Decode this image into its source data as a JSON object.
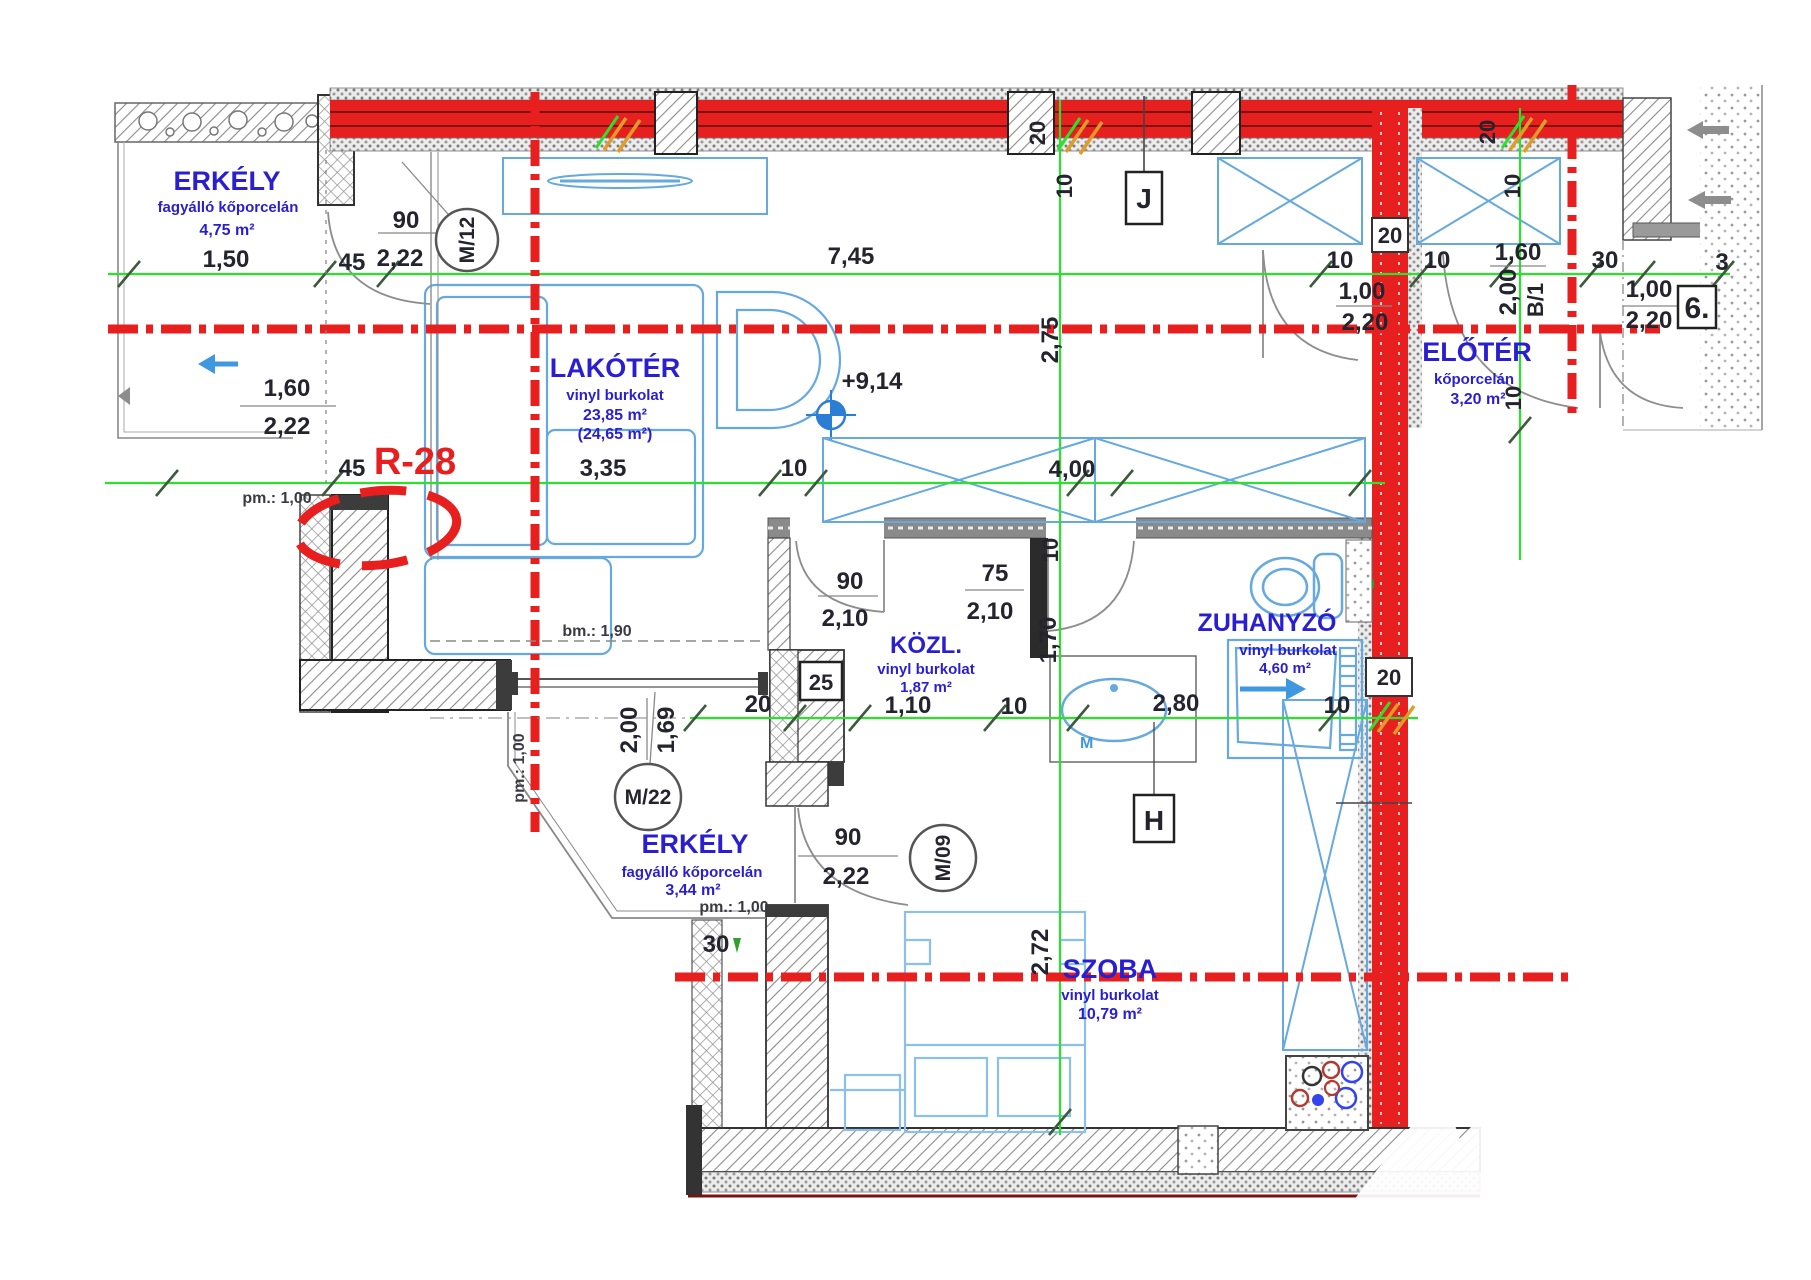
{
  "rooms": {
    "erkely1": {
      "name": "ERKÉLY",
      "material": "fagyálló kőporcelán",
      "area": "4,75 m²"
    },
    "lakoter": {
      "name": "LAKÓTÉR",
      "material": "vinyl burkolat",
      "area": "23,85 m²",
      "area_alt": "(24,65 m²)"
    },
    "eloter": {
      "name": "ELŐTÉR",
      "material": "kőporcelán",
      "area": "3,20 m²"
    },
    "kozl": {
      "name": "KÖZL.",
      "material": "vinyl burkolat",
      "area": "1,87 m²"
    },
    "zuhanyzo": {
      "name": "ZUHANYZÓ",
      "material": "vinyl burkolat",
      "area": "4,60 m²"
    },
    "erkely2": {
      "name": "ERKÉLY",
      "material": "fagyálló kőporcelán",
      "area": "3,44 m²"
    },
    "szoba": {
      "name": "SZOBA",
      "material": "vinyl burkolat",
      "area": "10,79 m²"
    }
  },
  "markers": {
    "m12": "M/12",
    "m22": "M/22",
    "m09": "M/09",
    "b1": "B/1",
    "j": "J",
    "h": "H",
    "unit": "6.",
    "r28": "R-28",
    "level": "+9,14"
  },
  "notes": {
    "bm": "bm.: 1,90",
    "pm_top": "pm.: 1,00",
    "pm_bottom": "pm.: 1,00",
    "pm_side": "pm.: 1,00",
    "m_basin": "M"
  },
  "dims": {
    "t1": "1,50",
    "t2": "45",
    "t3": "2,22",
    "t4": "7,45",
    "t5": "10",
    "t6": "1,00",
    "t7": "2,20",
    "t8": "10",
    "t9": "1,60",
    "t10": "2,00",
    "t11": "30",
    "t12": "1,00",
    "t13": "2,20",
    "t14": "3",
    "w20a": "20",
    "w20b": "20",
    "w20c": "20",
    "w20d": "20",
    "w25": "25",
    "w10a": "10",
    "w10b": "10",
    "v275": "2,75",
    "v10": "10",
    "v170": "1,70",
    "v10b": "10",
    "v272": "2,72",
    "m12w": "90",
    "bal1a": "1,60",
    "bal1b": "2,22",
    "mid45": "45",
    "mid335": "3,35",
    "mid10": "10",
    "mid400": "4,00",
    "kozlw": "90",
    "kozlh": "2,10",
    "zuhw": "75",
    "zuhh": "2,10",
    "b20": "20",
    "b110": "1,10",
    "b10a": "10",
    "b280": "2,80",
    "b10b": "10",
    "m22a": "2,00",
    "m22b": "1,69",
    "m09w": "90",
    "m09h": "2,22",
    "bal2_30": "30"
  },
  "colors": {
    "wall_red": "#e71f1f",
    "dim_green": "#2ee02e",
    "furniture_blue": "#66a9de",
    "label_blue": "#2a1fd0",
    "text_dark": "#23242e"
  }
}
